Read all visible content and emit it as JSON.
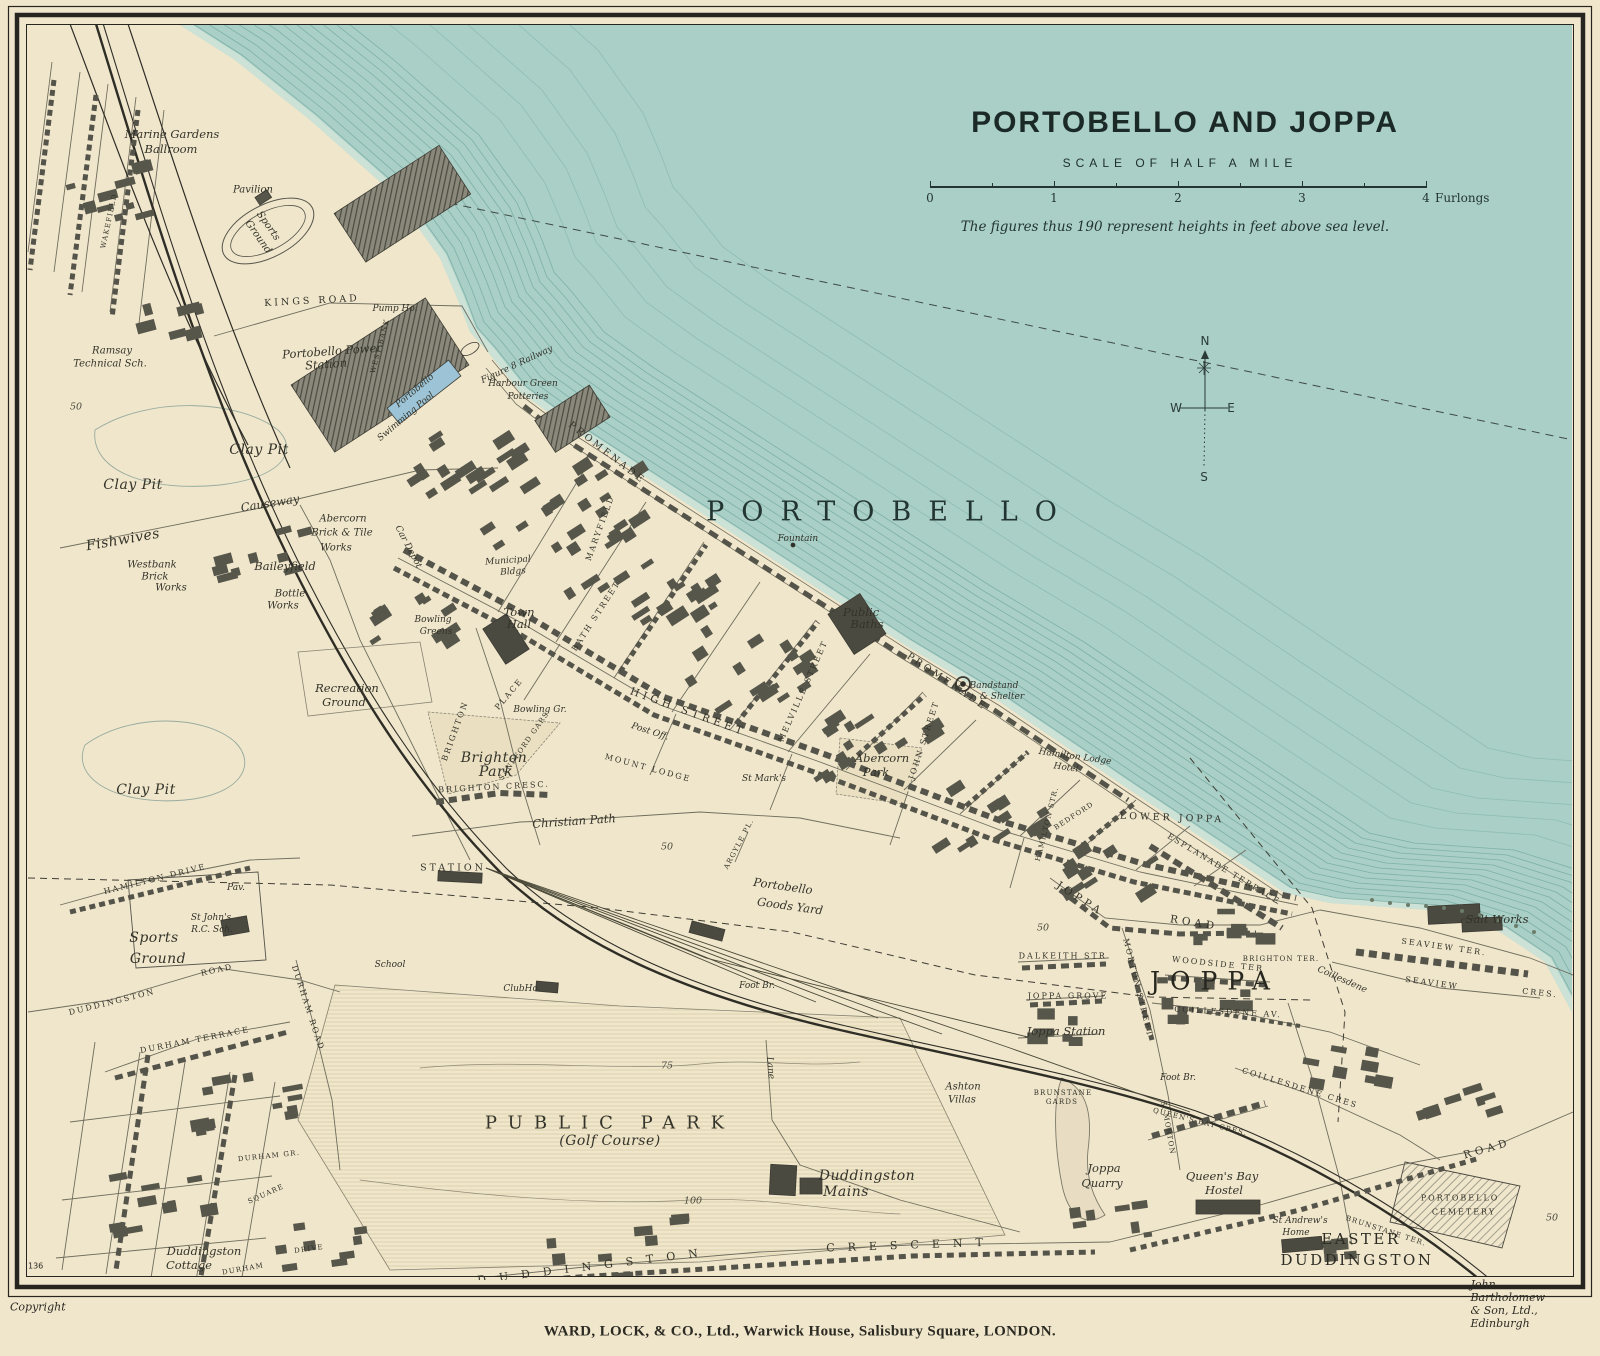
{
  "title_block": {
    "title": "PORTOBELLO AND JOPPA",
    "scale_heading": "SCALE OF HALF A MILE",
    "scale_ticks": [
      "0",
      "1",
      "2",
      "3",
      "4"
    ],
    "scale_units_label": "Furlongs",
    "note": "The figures thus 190 represent heights in feet above sea level."
  },
  "compass": {
    "north": "N",
    "south": "S",
    "east": "E",
    "west": "W"
  },
  "credits": {
    "copyright": "Copyright",
    "publisher": "WARD, LOCK, & CO., Ltd., Warwick House, Salisbury Square, LONDON.",
    "cartographer": "John Bartholomew & Son, Ltd., Edinburgh",
    "sheet_number": "136"
  },
  "colors": {
    "paper": "#f0e6cb",
    "sea": "#a9cfc7",
    "ink": "#33332a",
    "building": "#57564b",
    "pool_blue": "#9cc4d6"
  },
  "map_labels": [
    {
      "t": "Marine Gardens",
      "x": 172,
      "y": 134,
      "c": "place"
    },
    {
      "t": "Ballroom",
      "x": 171,
      "y": 149,
      "c": "place"
    },
    {
      "t": "Pavilion",
      "x": 253,
      "y": 190,
      "c": "place-sm"
    },
    {
      "t": "Sports",
      "x": 268,
      "y": 226,
      "r": 55,
      "c": "place-sm"
    },
    {
      "t": "Ground",
      "x": 258,
      "y": 237,
      "r": 55,
      "c": "place-sm"
    },
    {
      "t": "KINGS ROAD",
      "x": 312,
      "y": 301,
      "r": -3,
      "c": "street"
    },
    {
      "t": "Pump Ho.",
      "x": 395,
      "y": 309,
      "c": "tiny-it"
    },
    {
      "t": "Portobello Power",
      "x": 332,
      "y": 351,
      "r": -4,
      "c": "place"
    },
    {
      "t": "Station",
      "x": 326,
      "y": 364,
      "r": -4,
      "c": "place"
    },
    {
      "t": "Ramsay",
      "x": 112,
      "y": 351,
      "c": "place-sm"
    },
    {
      "t": "Technical Sch.",
      "x": 110,
      "y": 364,
      "c": "place-sm"
    },
    {
      "t": "Portobello",
      "x": 415,
      "y": 391,
      "r": -40,
      "c": "tiny-it"
    },
    {
      "t": "Swimming Pool",
      "x": 406,
      "y": 417,
      "r": -40,
      "c": "tiny-it"
    },
    {
      "t": "Figure 8 Railway",
      "x": 517,
      "y": 365,
      "r": -25,
      "c": "tiny-it"
    },
    {
      "t": "Harbour Green",
      "x": 523,
      "y": 384,
      "c": "tiny-it"
    },
    {
      "t": "Potteries",
      "x": 528,
      "y": 397,
      "c": "tiny-it"
    },
    {
      "t": "Clay Pit",
      "x": 259,
      "y": 450,
      "c": "place-lg"
    },
    {
      "t": "Clay Pit",
      "x": 133,
      "y": 485,
      "c": "place-lg"
    },
    {
      "t": "Fishwives",
      "x": 123,
      "y": 540,
      "r": -10,
      "c": "place-lg"
    },
    {
      "t": "Causeway",
      "x": 270,
      "y": 503,
      "r": -9,
      "c": "place"
    },
    {
      "t": "Westbank",
      "x": 152,
      "y": 565,
      "c": "place-sm"
    },
    {
      "t": "Brick",
      "x": 155,
      "y": 577,
      "c": "place-sm"
    },
    {
      "t": "Works",
      "x": 171,
      "y": 588,
      "c": "place-sm"
    },
    {
      "t": "Abercorn",
      "x": 343,
      "y": 519,
      "c": "place-sm"
    },
    {
      "t": "Brick & Tile",
      "x": 342,
      "y": 533,
      "c": "place-sm"
    },
    {
      "t": "Works",
      "x": 336,
      "y": 548,
      "c": "place-sm"
    },
    {
      "t": "Baileyfield",
      "x": 285,
      "y": 566,
      "c": "place"
    },
    {
      "t": "Bottle",
      "x": 290,
      "y": 594,
      "c": "place-sm"
    },
    {
      "t": "Works",
      "x": 283,
      "y": 606,
      "c": "place-sm"
    },
    {
      "t": "Car Depot",
      "x": 408,
      "y": 547,
      "r": 62,
      "c": "tiny-it"
    },
    {
      "t": "Municipal",
      "x": 508,
      "y": 561,
      "r": -4,
      "c": "tiny-it"
    },
    {
      "t": "Bldgs",
      "x": 513,
      "y": 572,
      "r": -4,
      "c": "tiny-it"
    },
    {
      "t": "Town",
      "x": 519,
      "y": 612,
      "c": "place"
    },
    {
      "t": "Hall",
      "x": 519,
      "y": 624,
      "c": "place"
    },
    {
      "t": "Bowling",
      "x": 433,
      "y": 620,
      "c": "tiny-it"
    },
    {
      "t": "Greens",
      "x": 436,
      "y": 632,
      "c": "tiny-it"
    },
    {
      "t": "MARYFIELD",
      "x": 600,
      "y": 528,
      "r": -70,
      "c": "street-sm"
    },
    {
      "t": "BATH STREET",
      "x": 596,
      "y": 616,
      "r": -57,
      "c": "street-sm"
    },
    {
      "t": "HIGH STREET",
      "x": 688,
      "y": 712,
      "r": 20,
      "c": "street-lg"
    },
    {
      "t": "Post Off.",
      "x": 650,
      "y": 732,
      "r": 18,
      "c": "tiny-it"
    },
    {
      "t": "MOUNT LODGE",
      "x": 648,
      "y": 768,
      "r": 15,
      "c": "street-sm"
    },
    {
      "t": "BRIGHTON",
      "x": 455,
      "y": 731,
      "r": -70,
      "c": "street-sm"
    },
    {
      "t": "PLACE",
      "x": 509,
      "y": 694,
      "r": -50,
      "c": "street-sm"
    },
    {
      "t": "SANDFORD GARS",
      "x": 524,
      "y": 746,
      "r": -55,
      "c": "street-xs"
    },
    {
      "t": "Brighton",
      "x": 494,
      "y": 758,
      "c": "place-lg"
    },
    {
      "t": "Park",
      "x": 496,
      "y": 772,
      "c": "place-lg"
    },
    {
      "t": "BRIGHTON CRESC.",
      "x": 494,
      "y": 787,
      "r": -3,
      "c": "street-sm"
    },
    {
      "t": "Christian Path",
      "x": 574,
      "y": 821,
      "r": -4,
      "c": "place"
    },
    {
      "t": "Recreation",
      "x": 347,
      "y": 688,
      "c": "place"
    },
    {
      "t": "Ground",
      "x": 344,
      "y": 702,
      "c": "place"
    },
    {
      "t": "WAKEFIELD",
      "x": 109,
      "y": 221,
      "r": -78,
      "c": "street-xs"
    },
    {
      "t": "STATION",
      "x": 453,
      "y": 868,
      "c": "street"
    },
    {
      "t": "Portobello",
      "x": 783,
      "y": 886,
      "r": 8,
      "c": "place"
    },
    {
      "t": "Goods Yard",
      "x": 790,
      "y": 906,
      "r": 8,
      "c": "place"
    },
    {
      "t": "ClubHo.",
      "x": 522,
      "y": 989,
      "c": "tiny-it"
    },
    {
      "t": "School",
      "x": 390,
      "y": 965,
      "c": "tiny-it"
    },
    {
      "t": "ARGYLE PL.",
      "x": 739,
      "y": 844,
      "r": -62,
      "c": "street-xs"
    },
    {
      "t": "Foot Br.",
      "x": 757,
      "y": 986,
      "c": "tiny-it"
    },
    {
      "t": "PROMENADE",
      "x": 607,
      "y": 453,
      "r": 38,
      "c": "street"
    },
    {
      "t": "PROMENADE",
      "x": 947,
      "y": 682,
      "r": 34,
      "c": "street"
    },
    {
      "t": "Public",
      "x": 861,
      "y": 612,
      "c": "place"
    },
    {
      "t": "Baths",
      "x": 867,
      "y": 624,
      "c": "place"
    },
    {
      "t": "Bandstand",
      "x": 994,
      "y": 686,
      "c": "tiny-it"
    },
    {
      "t": "& Shelter",
      "x": 1002,
      "y": 697,
      "c": "tiny-it"
    },
    {
      "t": "Fountain",
      "x": 798,
      "y": 539,
      "c": "tiny-it"
    },
    {
      "t": "MELVILLE STREET",
      "x": 803,
      "y": 691,
      "r": -66,
      "c": "street-sm"
    },
    {
      "t": "JOHN STREET",
      "x": 924,
      "y": 740,
      "r": -72,
      "c": "street-sm"
    },
    {
      "t": "Abercorn",
      "x": 882,
      "y": 758,
      "c": "place"
    },
    {
      "t": "Park",
      "x": 876,
      "y": 772,
      "c": "place"
    },
    {
      "t": "St Mark's",
      "x": 764,
      "y": 779,
      "c": "tiny-it"
    },
    {
      "t": "Hamilton Lodge",
      "x": 1075,
      "y": 757,
      "r": 8,
      "c": "tiny-it"
    },
    {
      "t": "Hotel",
      "x": 1066,
      "y": 768,
      "r": 8,
      "c": "tiny-it"
    },
    {
      "t": "LOWER JOPPA",
      "x": 1172,
      "y": 818,
      "r": 2,
      "c": "street"
    },
    {
      "t": "ESPLANADE TERRACE",
      "x": 1224,
      "y": 869,
      "r": 31,
      "c": "street-sm"
    },
    {
      "t": "HAMILTON STR.",
      "x": 1047,
      "y": 824,
      "r": -76,
      "c": "street-xs"
    },
    {
      "t": "BEDFORD",
      "x": 1074,
      "y": 816,
      "r": -33,
      "c": "street-xs"
    },
    {
      "t": "JOPPA",
      "x": 1080,
      "y": 899,
      "r": 33,
      "c": "street-lg"
    },
    {
      "t": "ROAD",
      "x": 1194,
      "y": 923,
      "r": 9,
      "c": "street-lg"
    },
    {
      "t": "DALKEITH STR.",
      "x": 1065,
      "y": 956,
      "c": "street-sm"
    },
    {
      "t": "JOPPA GROVE",
      "x": 1068,
      "y": 996,
      "c": "street-sm"
    },
    {
      "t": "Joppa Station",
      "x": 1066,
      "y": 1031,
      "c": "place"
    },
    {
      "t": "JOPPA",
      "x": 1215,
      "y": 981,
      "c": "joppa-name"
    },
    {
      "t": "WOODSIDE TER",
      "x": 1218,
      "y": 964,
      "r": 6,
      "c": "street-sm"
    },
    {
      "t": "BRIGHTON TER.",
      "x": 1281,
      "y": 959,
      "c": "street-xs"
    },
    {
      "t": "MORTON STREET",
      "x": 1138,
      "y": 988,
      "r": 76,
      "c": "street-sm"
    },
    {
      "t": "COILLESDENE AV.",
      "x": 1228,
      "y": 1012,
      "r": 3,
      "c": "street-sm"
    },
    {
      "t": "Coillesdene",
      "x": 1342,
      "y": 980,
      "r": 24,
      "c": "tiny-it"
    },
    {
      "t": "Salt Works",
      "x": 1497,
      "y": 919,
      "c": "place"
    },
    {
      "t": "SEAVIEW TER.",
      "x": 1444,
      "y": 947,
      "r": 8,
      "c": "street-sm"
    },
    {
      "t": "SEAVIEW",
      "x": 1432,
      "y": 983,
      "r": 8,
      "c": "street-sm"
    },
    {
      "t": "CRES.",
      "x": 1540,
      "y": 993,
      "r": 6,
      "c": "street-sm"
    },
    {
      "t": "50",
      "x": 667,
      "y": 847,
      "c": "contour"
    },
    {
      "t": "50",
      "x": 1043,
      "y": 928,
      "c": "contour"
    },
    {
      "t": "50",
      "x": 76,
      "y": 407,
      "c": "contour"
    },
    {
      "t": "50",
      "x": 1552,
      "y": 1218,
      "c": "contour"
    },
    {
      "t": "75",
      "x": 667,
      "y": 1066,
      "c": "contour"
    },
    {
      "t": "100",
      "x": 693,
      "y": 1201,
      "c": "contour"
    },
    {
      "t": "PUBLIC PARK",
      "x": 610,
      "y": 1123,
      "c": "park-name"
    },
    {
      "t": "(Golf Course)",
      "x": 610,
      "y": 1141,
      "c": "place-lg"
    },
    {
      "t": "Lane",
      "x": 770,
      "y": 1068,
      "r": 85,
      "c": "tiny-it"
    },
    {
      "t": "Duddingston",
      "x": 867,
      "y": 1176,
      "c": "place-lg"
    },
    {
      "t": "Mains",
      "x": 846,
      "y": 1192,
      "c": "place-lg"
    },
    {
      "t": "DUDDINGSTON",
      "x": 594,
      "y": 1266,
      "r": -7,
      "c": "street-wide"
    },
    {
      "t": "CRESCENT",
      "x": 911,
      "y": 1245,
      "r": -2,
      "c": "street-wide"
    },
    {
      "t": "Duddingston",
      "x": 204,
      "y": 1251,
      "c": "place"
    },
    {
      "t": "Cottage",
      "x": 189,
      "y": 1265,
      "c": "place"
    },
    {
      "t": "DURHAM",
      "x": 243,
      "y": 1269,
      "r": -10,
      "c": "street-xs"
    },
    {
      "t": "DRIVE",
      "x": 309,
      "y": 1249,
      "r": -8,
      "c": "street-xs"
    },
    {
      "t": "DURHAM TERRACE",
      "x": 195,
      "y": 1040,
      "r": -11,
      "c": "street-sm"
    },
    {
      "t": "DURHAM ROAD",
      "x": 308,
      "y": 1008,
      "r": 72,
      "c": "street-sm"
    },
    {
      "t": "SQUARE",
      "x": 266,
      "y": 1194,
      "r": -24,
      "c": "street-xs"
    },
    {
      "t": "DURHAM GR.",
      "x": 269,
      "y": 1156,
      "r": -6,
      "c": "street-xs"
    },
    {
      "t": "HAMILTON DRIVE",
      "x": 155,
      "y": 879,
      "r": -14,
      "c": "street-sm"
    },
    {
      "t": "DUDDINGSTON",
      "x": 112,
      "y": 1002,
      "r": -14,
      "c": "street-sm"
    },
    {
      "t": "ROAD",
      "x": 217,
      "y": 970,
      "r": -12,
      "c": "street-sm"
    },
    {
      "t": "St John's",
      "x": 211,
      "y": 918,
      "c": "tiny-it"
    },
    {
      "t": "R.C. Sch.",
      "x": 212,
      "y": 930,
      "c": "tiny-it"
    },
    {
      "t": "Pav.",
      "x": 236,
      "y": 888,
      "c": "tiny-it"
    },
    {
      "t": "Sports",
      "x": 154,
      "y": 938,
      "c": "place-lg"
    },
    {
      "t": "Ground",
      "x": 158,
      "y": 959,
      "c": "place-lg"
    },
    {
      "t": "Clay Pit",
      "x": 146,
      "y": 790,
      "c": "place-lg"
    },
    {
      "t": "Ashton",
      "x": 963,
      "y": 1087,
      "c": "place-sm"
    },
    {
      "t": "Villas",
      "x": 962,
      "y": 1100,
      "c": "place-sm"
    },
    {
      "t": "Joppa",
      "x": 1104,
      "y": 1168,
      "c": "place"
    },
    {
      "t": "Quarry",
      "x": 1102,
      "y": 1183,
      "c": "place"
    },
    {
      "t": "Queen's Bay",
      "x": 1222,
      "y": 1176,
      "c": "place"
    },
    {
      "t": "Hostel",
      "x": 1224,
      "y": 1190,
      "c": "place"
    },
    {
      "t": "QUEEN'S BAY CRES.",
      "x": 1200,
      "y": 1122,
      "r": 14,
      "c": "street-xs"
    },
    {
      "t": "BRUNSTANE",
      "x": 1063,
      "y": 1093,
      "c": "street-xs"
    },
    {
      "t": "GARDS",
      "x": 1062,
      "y": 1102,
      "c": "street-xs"
    },
    {
      "t": "Foot Br.",
      "x": 1178,
      "y": 1078,
      "c": "tiny-it"
    },
    {
      "t": "S. MORTON",
      "x": 1168,
      "y": 1128,
      "r": 80,
      "c": "street-xs"
    },
    {
      "t": "COILLESDENE CRES",
      "x": 1300,
      "y": 1088,
      "r": 17,
      "c": "street-sm"
    },
    {
      "t": "St Andrew's",
      "x": 1300,
      "y": 1221,
      "c": "tiny-it"
    },
    {
      "t": "Home",
      "x": 1296,
      "y": 1233,
      "c": "tiny-it"
    },
    {
      "t": "BRUNSTANE TER.",
      "x": 1386,
      "y": 1231,
      "r": 18,
      "c": "street-xs"
    },
    {
      "t": "EASTER",
      "x": 1361,
      "y": 1239,
      "c": "area-caps"
    },
    {
      "t": "DUDDINGSTON",
      "x": 1357,
      "y": 1260,
      "c": "area-caps"
    },
    {
      "t": "PORTOBELLO",
      "x": 1460,
      "y": 1198,
      "c": "street-sm"
    },
    {
      "t": "CEMETERY",
      "x": 1464,
      "y": 1212,
      "c": "street-sm"
    },
    {
      "t": "ROAD",
      "x": 1487,
      "y": 1149,
      "r": -16,
      "c": "street-lg"
    },
    {
      "t": "WEST BANK",
      "x": 380,
      "y": 346,
      "r": -75,
      "c": "street-xs"
    },
    {
      "t": "Bowling Gr.",
      "x": 540,
      "y": 710,
      "c": "tiny-it"
    },
    {
      "t": "PORTOBELLO",
      "x": 890,
      "y": 512,
      "c": "sea-name"
    }
  ]
}
